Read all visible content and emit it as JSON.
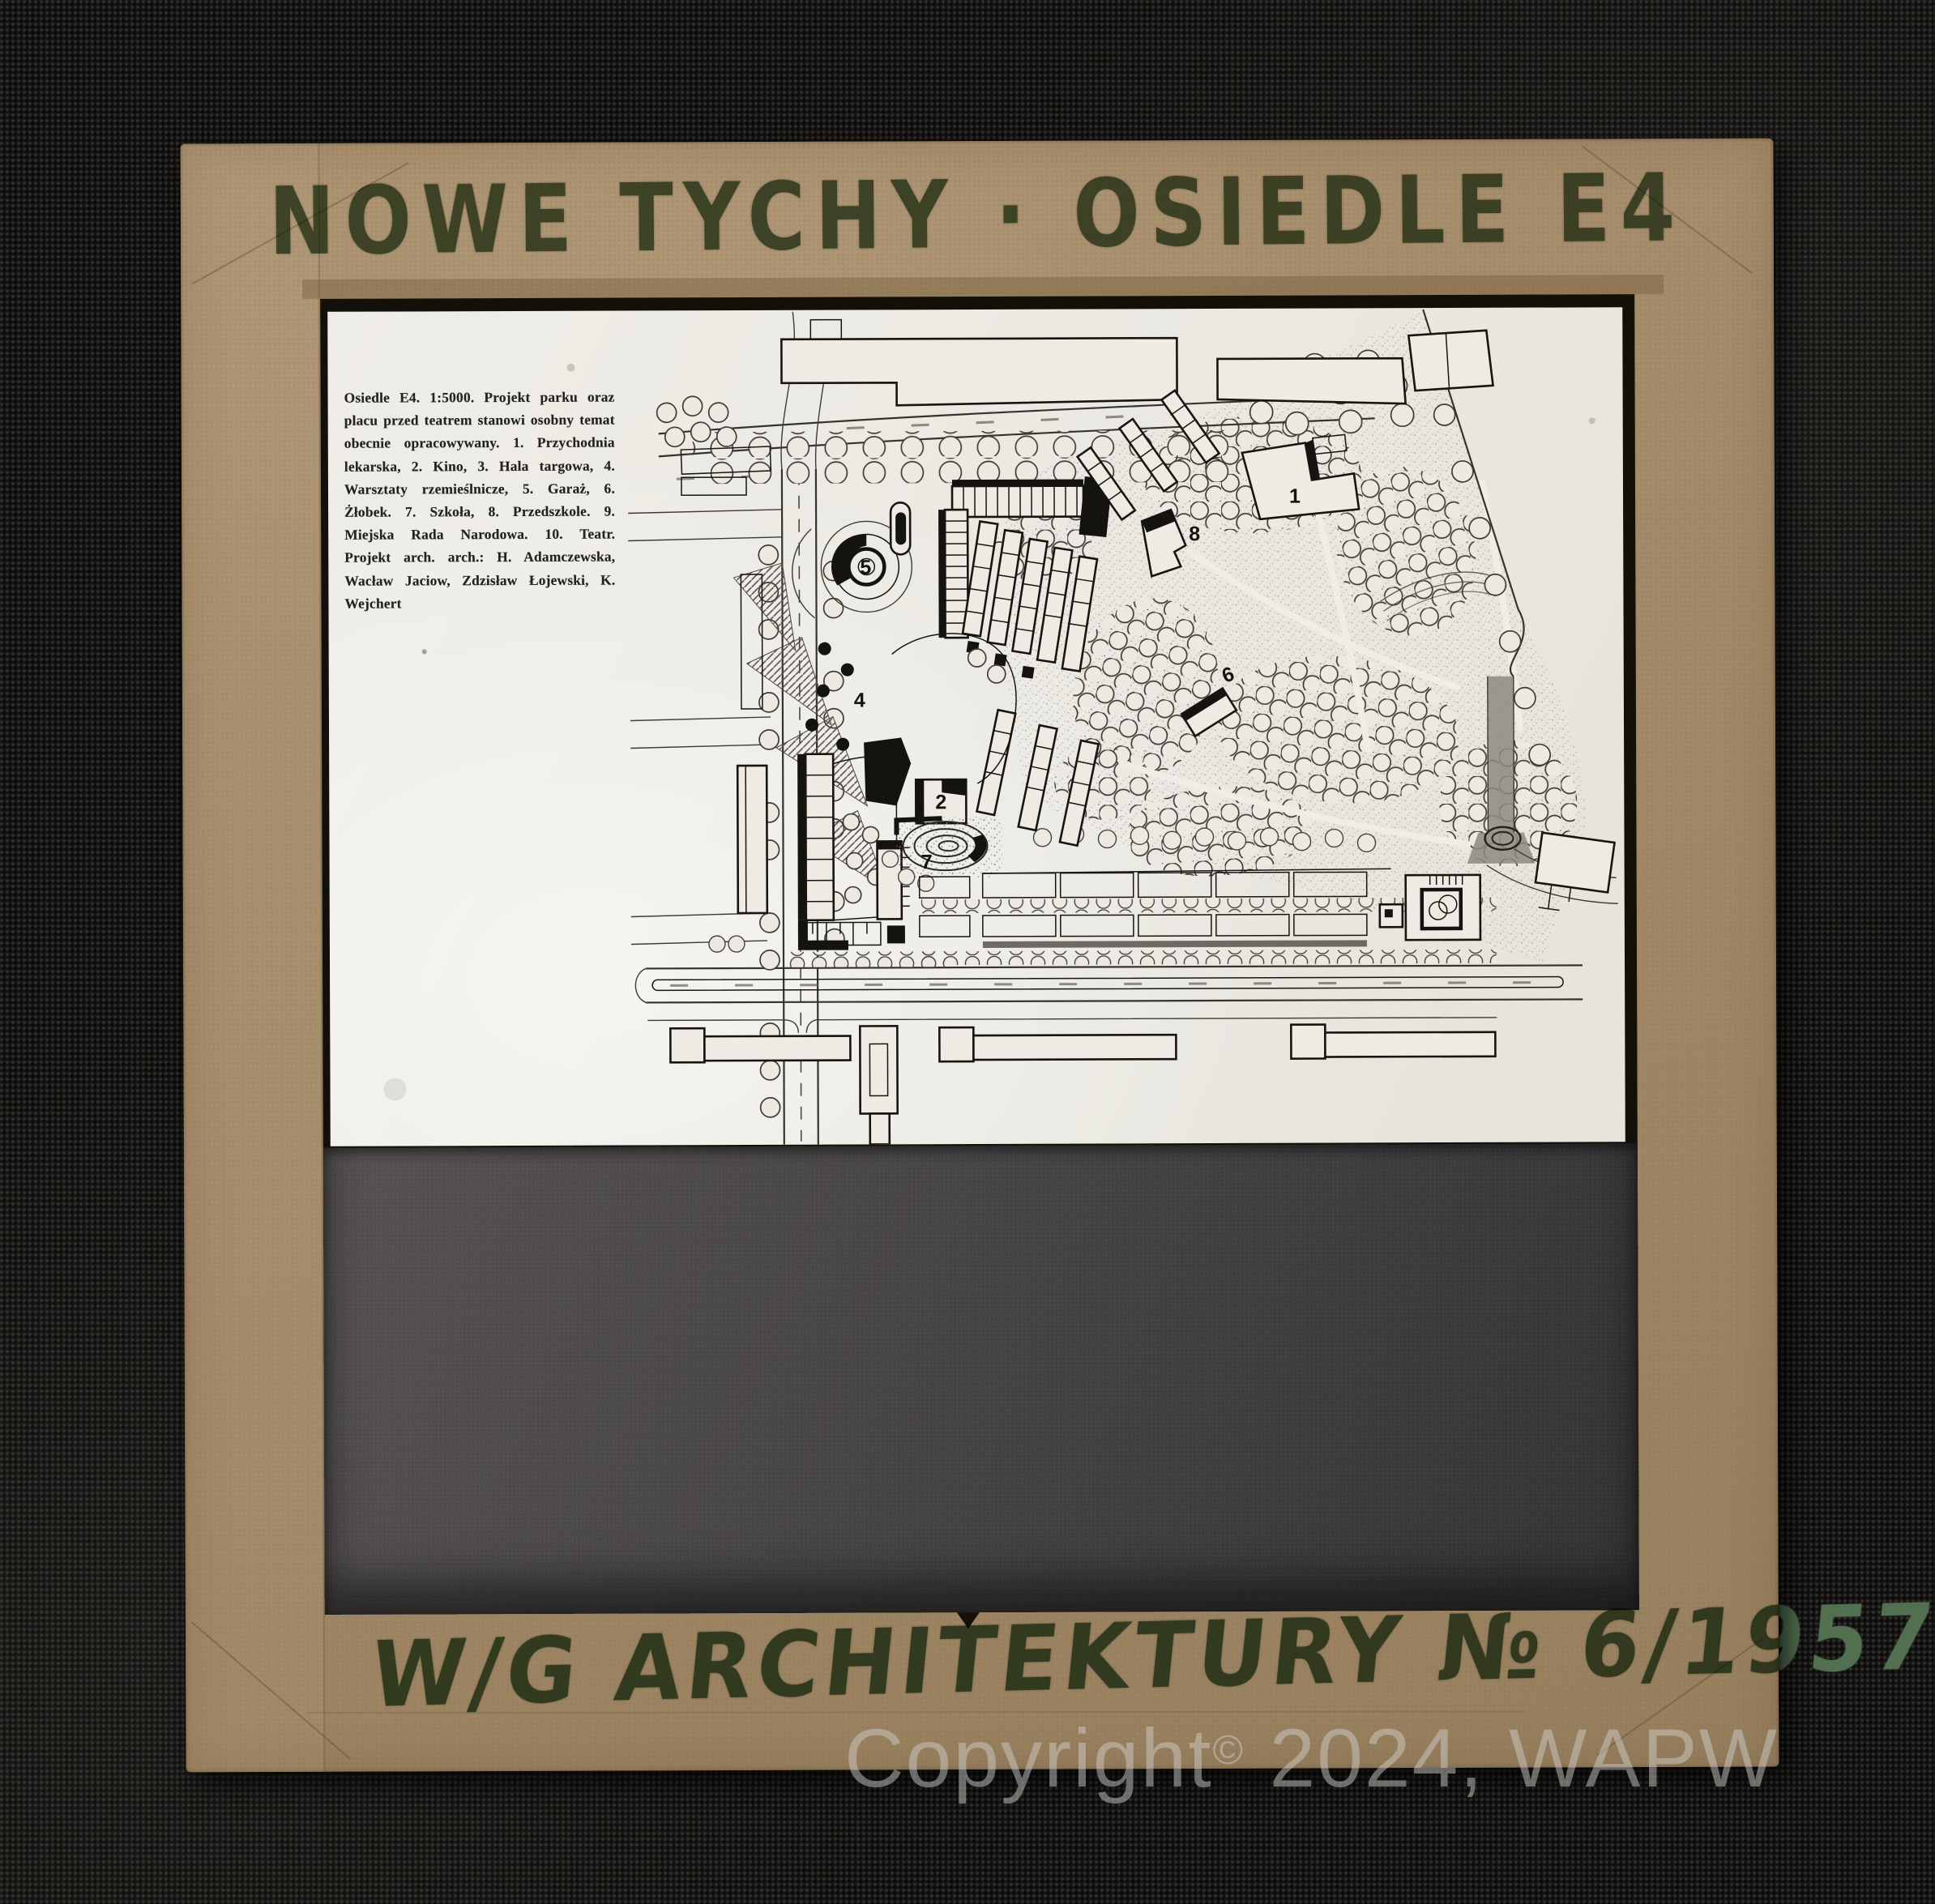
{
  "slide": {
    "top_handwriting": "NOWE TYCHY · OSIEDLE E4",
    "bottom_handwriting": "W/G ARCHITEKTURY № 6/1957"
  },
  "watermark": {
    "pre": "Copyright",
    "sup": "©",
    "post": " 2024, WAPW"
  },
  "photo": {
    "caption_text": "Osiedle E4. 1:5000. Projekt parku oraz placu przed teatrem stanowi osobny temat obecnie opracowywany. 1. Przychodnia lekarska, 2. Kino, 3. Hala targowa, 4. Warsztaty rzemieślnicze, 5. Garaż, 6. Żłobek. 7. Szkoła, 8. Przedszkole. 9. Miejska Rada Narodowa. 10. Teatr. Projekt arch. arch.: H. Adamczewska, Wacław Jaciow, Zdzisław Łojewski, K. Wejchert",
    "map_labels": [
      "5",
      "1",
      "4",
      "6",
      "2",
      "7",
      "8"
    ]
  },
  "colors": {
    "fabric": "#161514",
    "cardboard": "#a38a68",
    "ink_green": "#5b7355",
    "paper": "#ecebe4",
    "mask_paper": "#454243",
    "plan_ink": "#15130e"
  }
}
